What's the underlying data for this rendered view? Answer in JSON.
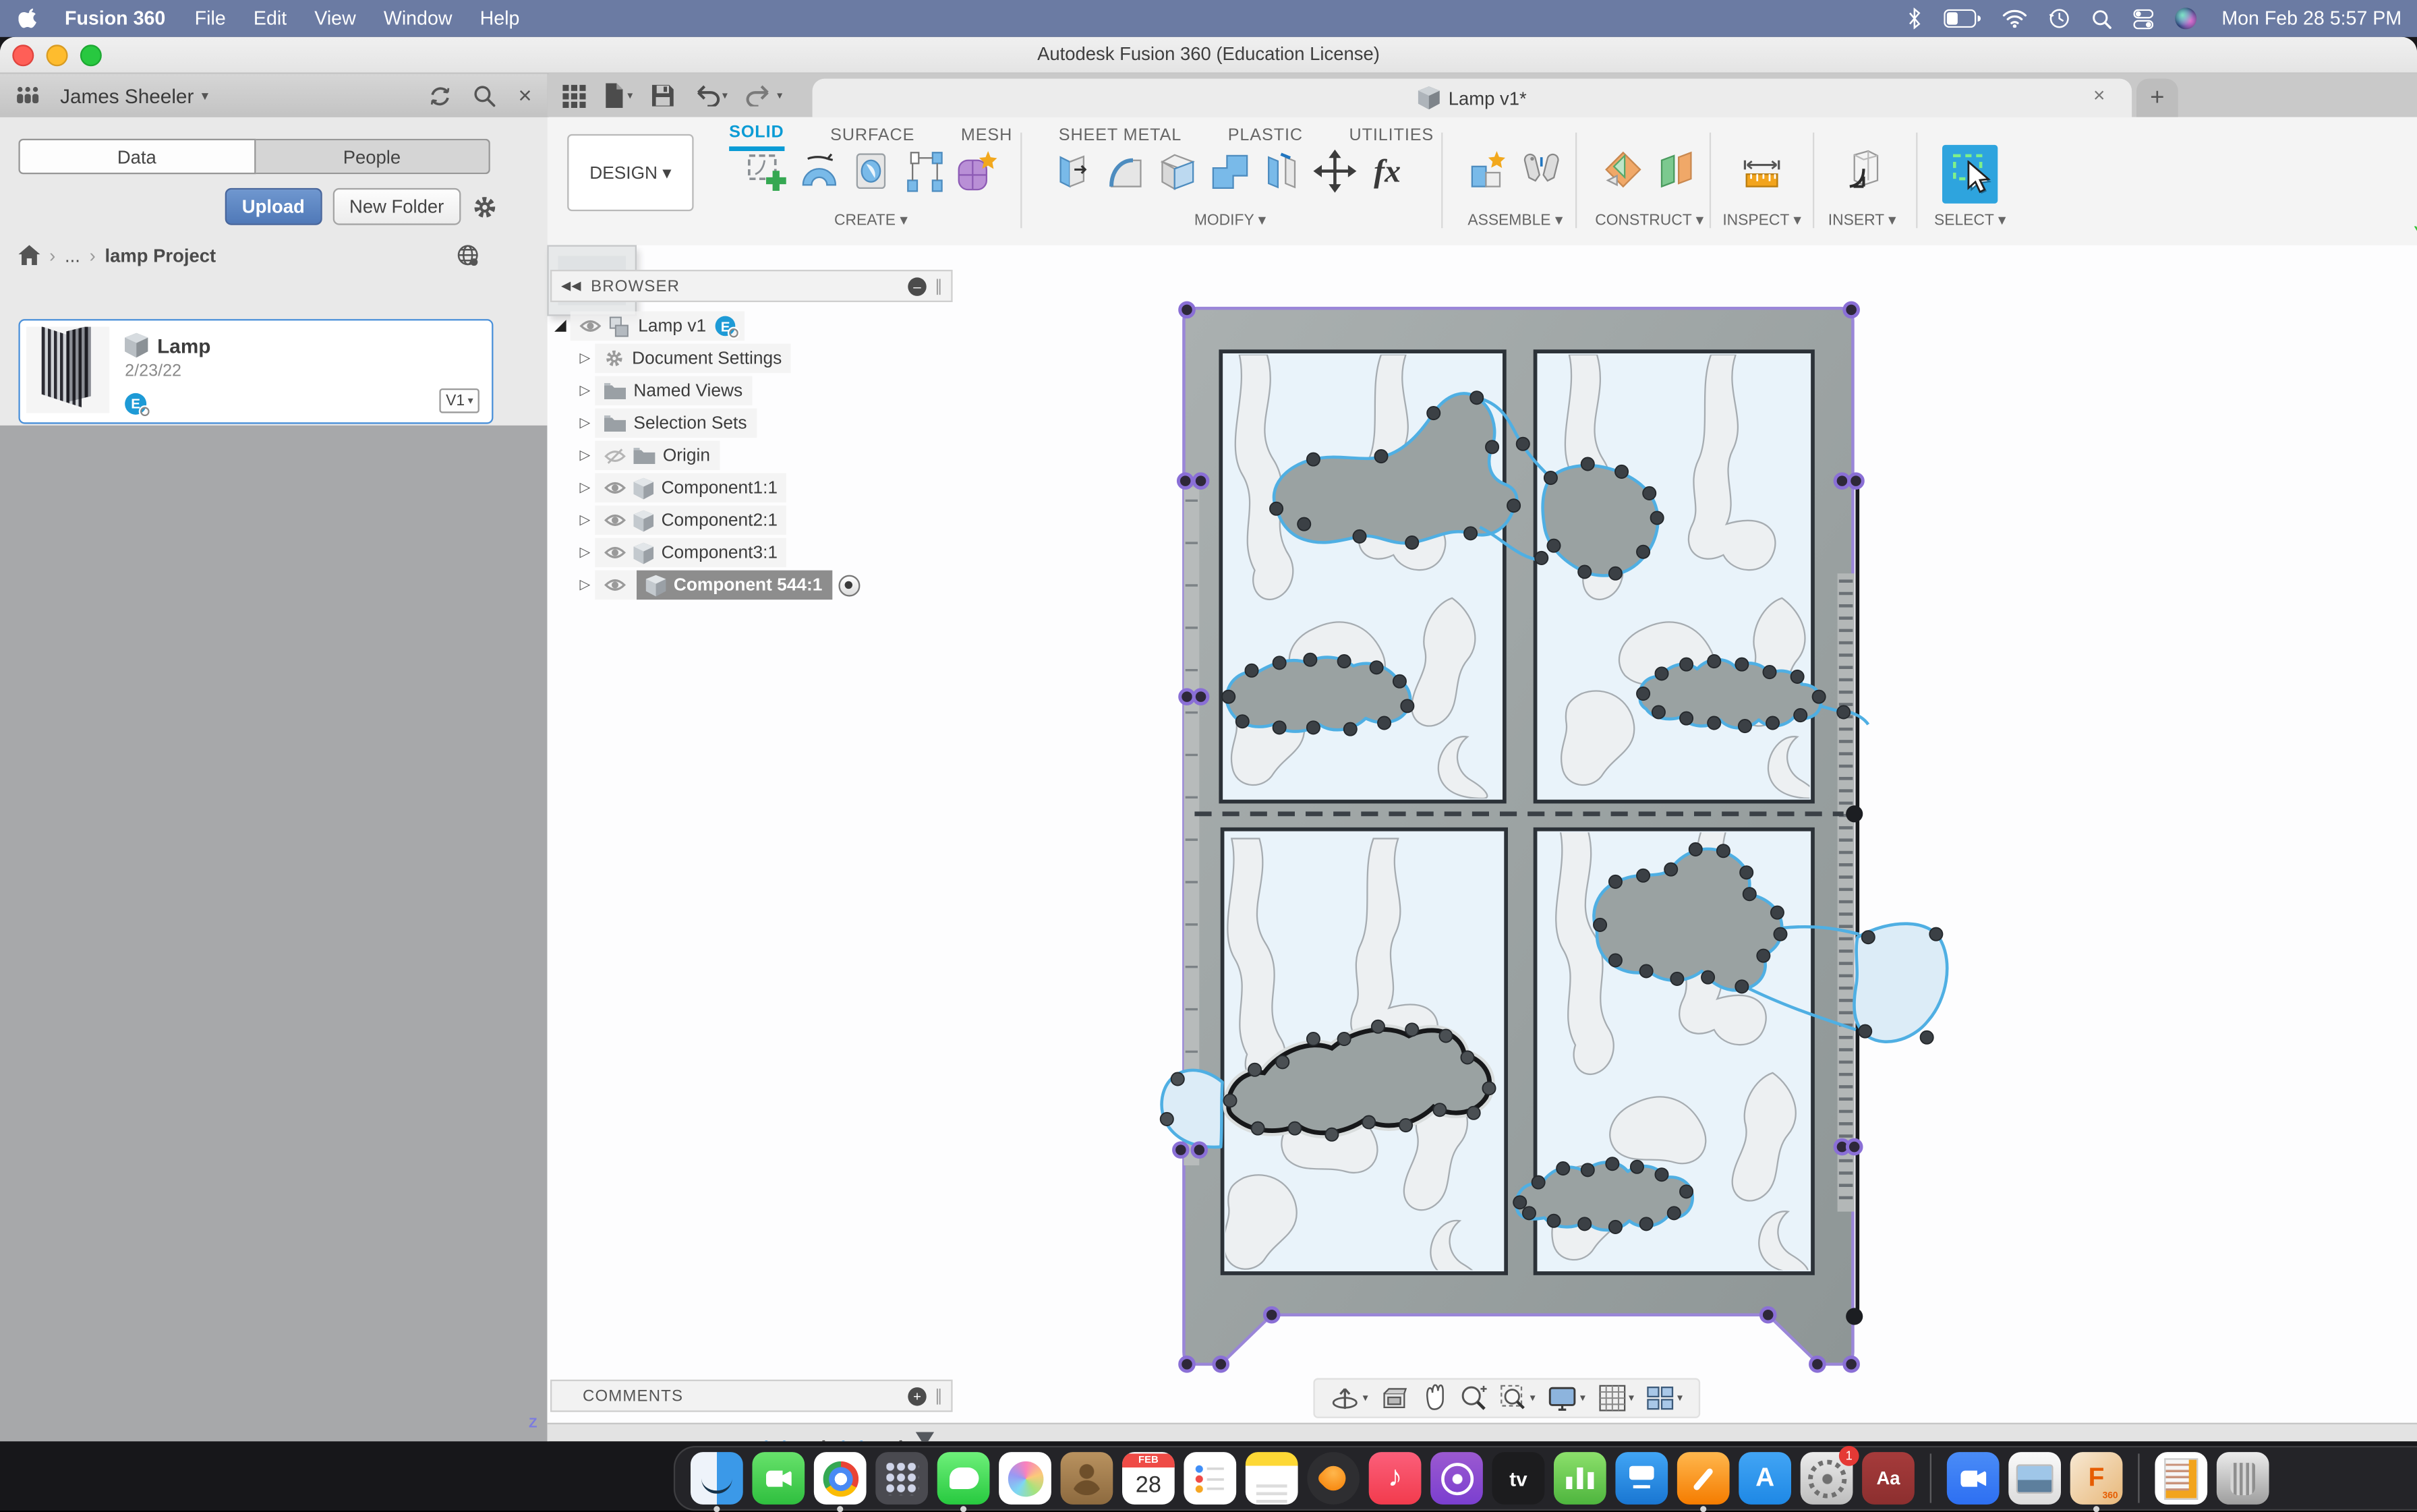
{
  "colors": {
    "accent_blue": "#0a9bd5",
    "selection_purple": "#8a6fd6",
    "spline_cyan": "#4fafe3",
    "menu_bar_blue": "#6b7ba3",
    "upload_blue": "#5079b8",
    "badge_blue": "#1d9ad6"
  },
  "menu_bar": {
    "app_name": "Fusion 360",
    "items": [
      "File",
      "Edit",
      "View",
      "Window",
      "Help"
    ],
    "status_icons": [
      "bluetooth",
      "battery",
      "wifi",
      "time-machine",
      "search",
      "control-center",
      "siri"
    ],
    "clock": "Mon Feb 28  5:57 PM"
  },
  "window_title": "Autodesk Fusion 360 (Education License)",
  "data_panel": {
    "user_name": "James Sheeler",
    "tab_data": "Data",
    "tab_people": "People",
    "upload": "Upload",
    "new_folder": "New Folder",
    "breadcrumb_ellipsis": "...",
    "breadcrumb_project": "lamp Project",
    "item": {
      "name": "Lamp",
      "date": "2/23/22",
      "version": "V1",
      "owner_badge": "E"
    }
  },
  "document_tab": {
    "title": "Lamp v1*"
  },
  "ribbon": {
    "design": "DESIGN ▾",
    "tabs": [
      "SOLID",
      "SURFACE",
      "MESH",
      "SHEET METAL",
      "PLASTIC",
      "UTILITIES"
    ],
    "active_tab": "SOLID",
    "groups": [
      "CREATE ▾",
      "MODIFY ▾",
      "ASSEMBLE ▾",
      "CONSTRUCT ▾",
      "INSPECT ▾",
      "INSERT ▾",
      "SELECT ▾"
    ],
    "fx_glyph": "fx"
  },
  "browser": {
    "title": "BROWSER",
    "root_label": "Lamp v1",
    "root_badge": "E",
    "rows": [
      {
        "label": "Document Settings",
        "icon": "gear"
      },
      {
        "label": "Named Views",
        "icon": "folder"
      },
      {
        "label": "Selection Sets",
        "icon": "folder"
      },
      {
        "label": "Origin",
        "icon": "folder-hidden"
      },
      {
        "label": "Component1:1",
        "icon": "component"
      },
      {
        "label": "Component2:1",
        "icon": "component"
      },
      {
        "label": "Component3:1",
        "icon": "component"
      },
      {
        "label": "Component 544:1",
        "icon": "component",
        "selected": true,
        "activated": true
      }
    ]
  },
  "viewcube": {
    "face": "RIGHT",
    "axis_x": "X",
    "axis_y": "Y",
    "axis_z": "Z"
  },
  "comments": {
    "title": "COMMENTS"
  },
  "timeline": {
    "features": [
      "sketch",
      "extrude",
      "sketch",
      "extrude"
    ]
  },
  "dock": {
    "items": [
      {
        "name": "finder",
        "label": "Finder",
        "kind": "finder",
        "running": true
      },
      {
        "name": "facetime",
        "label": "FaceTime",
        "kind": "facetime"
      },
      {
        "name": "chrome",
        "label": "Google Chrome",
        "kind": "chrome",
        "running": true
      },
      {
        "name": "launchpad",
        "label": "Launchpad",
        "kind": "launchpad"
      },
      {
        "name": "messages",
        "label": "Messages",
        "kind": "messages",
        "running": true
      },
      {
        "name": "photos",
        "label": "Photos",
        "kind": "photos"
      },
      {
        "name": "contacts",
        "label": "Contacts",
        "kind": "contacts"
      },
      {
        "name": "calendar",
        "label": "Calendar",
        "kind": "calendar",
        "month": "FEB",
        "day": "28"
      },
      {
        "name": "reminders",
        "label": "Reminders",
        "kind": "reminders"
      },
      {
        "name": "notes",
        "label": "Notes",
        "kind": "notes"
      },
      {
        "name": "fl-studio",
        "label": "FL Studio",
        "kind": "fl"
      },
      {
        "name": "music",
        "label": "Music",
        "kind": "music",
        "glyph": "♪"
      },
      {
        "name": "podcasts",
        "label": "Podcasts",
        "kind": "podcasts"
      },
      {
        "name": "apple-tv",
        "label": "Apple TV",
        "kind": "appletv",
        "glyph": "tv"
      },
      {
        "name": "numbers",
        "label": "Numbers",
        "kind": "numbers"
      },
      {
        "name": "keynote",
        "label": "Keynote",
        "kind": "keynote"
      },
      {
        "name": "pages",
        "label": "Pages",
        "kind": "pages",
        "running": true
      },
      {
        "name": "app-store",
        "label": "App Store",
        "kind": "appstore",
        "glyph": "A"
      },
      {
        "name": "system-preferences",
        "label": "System Preferences",
        "kind": "settings",
        "badge": "1"
      },
      {
        "name": "dictionary",
        "label": "Dictionary",
        "kind": "dictionary",
        "glyph": "Aa"
      },
      {
        "name": "separator",
        "kind": "sep"
      },
      {
        "name": "zoom",
        "label": "Zoom",
        "kind": "zoomapp"
      },
      {
        "name": "preview-document",
        "label": "Preview",
        "kind": "preview"
      },
      {
        "name": "fusion-360",
        "label": "Autodesk Fusion 360",
        "kind": "fusion",
        "glyph": "F",
        "sub": "360",
        "running": true
      },
      {
        "name": "separator",
        "kind": "sep"
      },
      {
        "name": "document",
        "label": "Document",
        "kind": "docfile"
      },
      {
        "name": "trash",
        "label": "Trash",
        "kind": "trash"
      }
    ]
  }
}
